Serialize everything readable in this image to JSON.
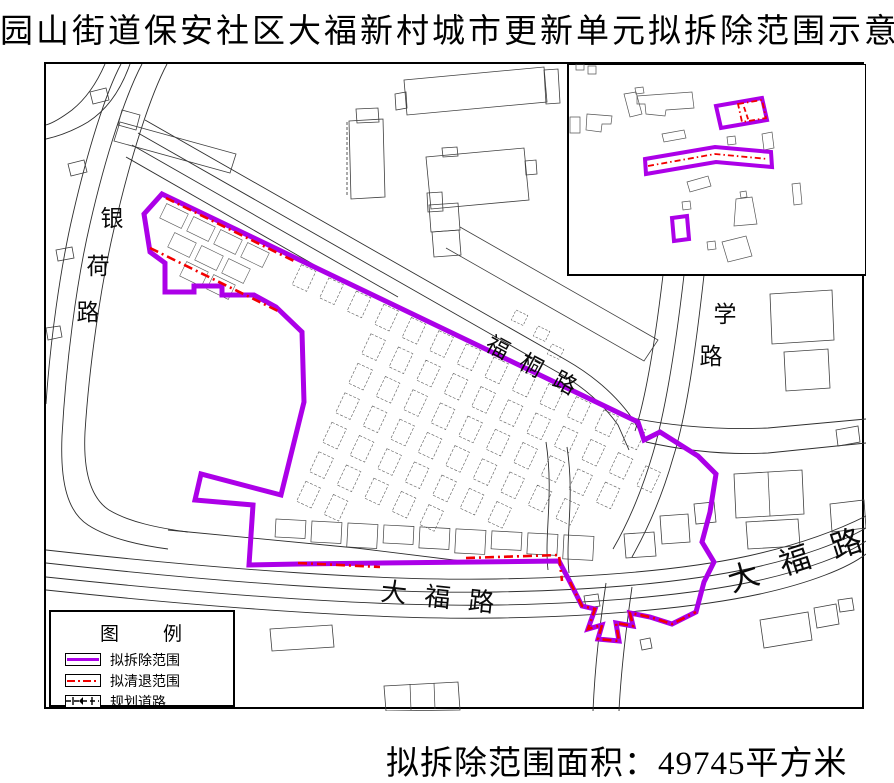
{
  "title": "园山街道保安社区大福新村城市更新单元拟拆除范围示意图",
  "area_note": "拟拆除范围面积：49745平方米",
  "legend": {
    "title": "图　　例",
    "items": [
      {
        "label": "拟拆除范围",
        "type": "demolition-boundary",
        "color": "#AC00E8"
      },
      {
        "label": "拟清退范围",
        "type": "clearance-boundary",
        "color": "#F20000"
      },
      {
        "label": "规划道路",
        "type": "planned-road",
        "color": "#000000"
      }
    ]
  },
  "road_labels": {
    "yinhe": "银荷路",
    "futong": "福桐路",
    "xue": "学路",
    "dafu_bottom": "大福路",
    "dafu_right": "大福路"
  },
  "colors": {
    "demolition": "#AC00E8",
    "clearance": "#F20000",
    "road_line": "#2e2e2e",
    "building_line": "#3f3f3f",
    "grid_cell_line": "#5c5c5c"
  }
}
